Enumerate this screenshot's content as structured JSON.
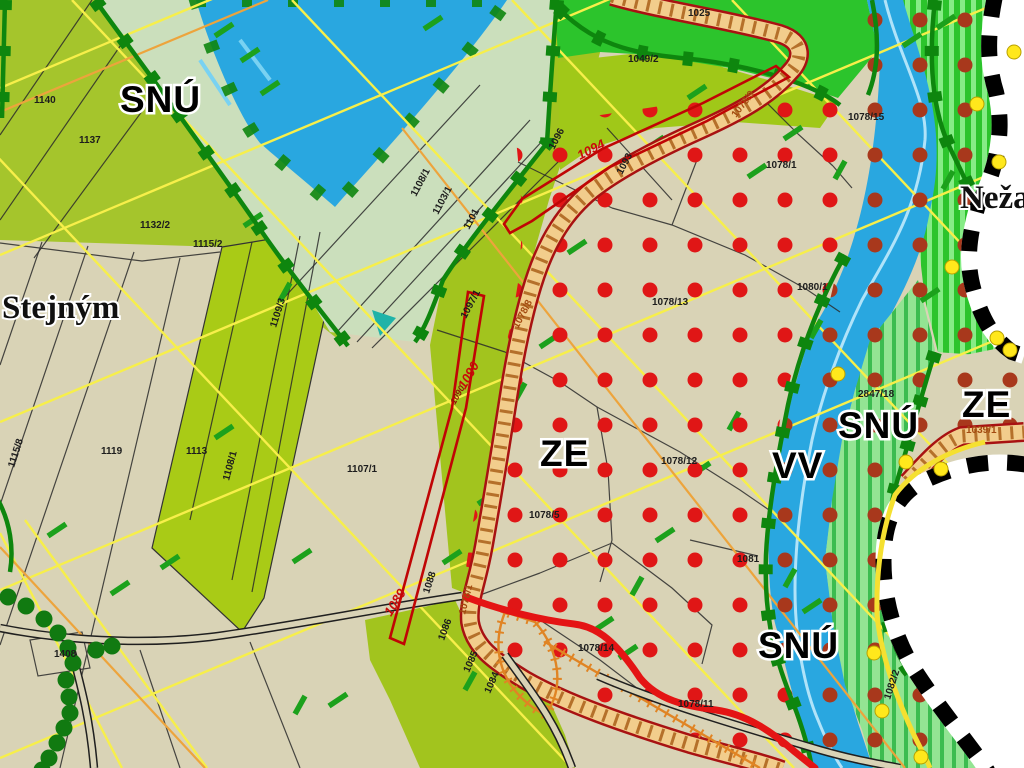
{
  "map": {
    "zones": [
      {
        "label": "SNÚ"
      },
      {
        "label": "ZE"
      },
      {
        "label": "VV"
      },
      {
        "label": "SNÚ"
      },
      {
        "label": "ZE"
      },
      {
        "label": "SNÚ"
      }
    ],
    "places": [
      {
        "label": "Stejným"
      },
      {
        "label": "Neža"
      }
    ],
    "parcels": [
      {
        "t": "1140"
      },
      {
        "t": "1137"
      },
      {
        "t": "1132/2"
      },
      {
        "t": "1115/2"
      },
      {
        "t": "1115/8"
      },
      {
        "t": "1119"
      },
      {
        "t": "1113"
      },
      {
        "t": "1109/3"
      },
      {
        "t": "1108/1"
      },
      {
        "t": "1107/1"
      },
      {
        "t": "1408"
      },
      {
        "t": "1108/1"
      },
      {
        "t": "1103/1"
      },
      {
        "t": "1101"
      },
      {
        "t": "1096"
      },
      {
        "t": "1093"
      },
      {
        "t": "1049/2"
      },
      {
        "t": "1025"
      },
      {
        "t": "1078/9"
      },
      {
        "t": "1078/1"
      },
      {
        "t": "1078/15"
      },
      {
        "t": "1078/13"
      },
      {
        "t": "1080/1"
      },
      {
        "t": "2847/18"
      },
      {
        "t": "1039/1"
      },
      {
        "t": "1078/12"
      },
      {
        "t": "1078/5"
      },
      {
        "t": "1097/1"
      },
      {
        "t": "1078/8"
      },
      {
        "t": "1088"
      },
      {
        "t": "1078/1"
      },
      {
        "t": "1086"
      },
      {
        "t": "1085"
      },
      {
        "t": "1084"
      },
      {
        "t": "1078/14"
      },
      {
        "t": "1078/11"
      },
      {
        "t": "1081"
      },
      {
        "t": "1082/2"
      },
      {
        "t": "1090"
      },
      {
        "t": "1094"
      },
      {
        "t": "1089"
      },
      {
        "t": "1090"
      }
    ],
    "colors": {
      "beige": "#d9d3b6",
      "olive_field": "#a5c52c",
      "pale_green": "#cbdfbc",
      "water_blue": "#29a7e0",
      "bright_green": "#2cc42c",
      "stripe_light_green": "#93e493",
      "border_dark_green": "#0e860e",
      "red_dot": "#e01616",
      "dark_red_dot": "#a8381c",
      "road_fill": "#f2cd8c",
      "road_edge": "#a81212",
      "route_red": "#e41414",
      "red_outline": "#c00505",
      "yellow_line": "#f7ef4a",
      "orange_line": "#eda43c",
      "boundary_dot_yellow": "#ffe81c"
    }
  }
}
